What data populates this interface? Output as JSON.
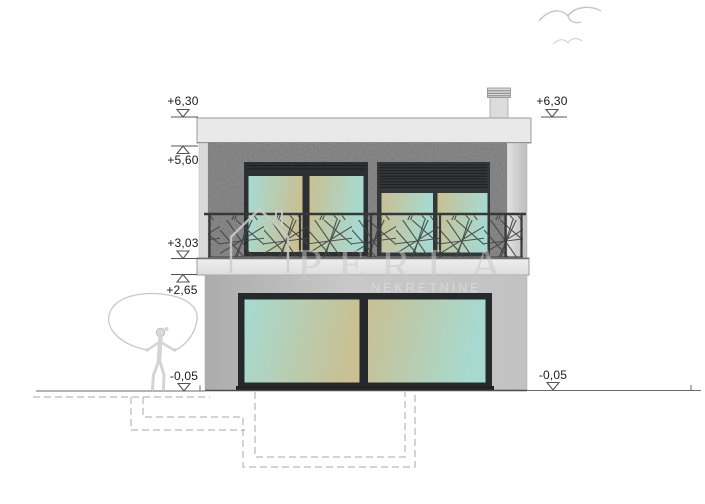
{
  "page": {
    "kind": "architectural elevation drawing of a two-storey house",
    "background": "#ffffff"
  },
  "levels": {
    "left_parapet": "+6,30",
    "left_roof": "+5,60",
    "left_balcony_top": "+3,03",
    "left_balcony_bottom": "+2,65",
    "left_ground": "-0,05",
    "right_parapet": "+6,30",
    "right_ground": "-0,05"
  },
  "watermark": {
    "brand": "PERLA",
    "subtitle": "NEKRETNINE"
  },
  "colors": {
    "upper_wall_stucco": "#757575",
    "lower_wall": "#c0c0c0",
    "slab": "#e8e8e8",
    "window_frame": "#2d3033",
    "glass_teal": "#a6dad1",
    "glass_tan": "#c9c093",
    "railing": "#3f4143",
    "ground_line": "#6a6a6a",
    "dashed_foundation": "#a9a9a9",
    "sketch": "#c9c9c9",
    "level_text": "#1b1b1b"
  }
}
